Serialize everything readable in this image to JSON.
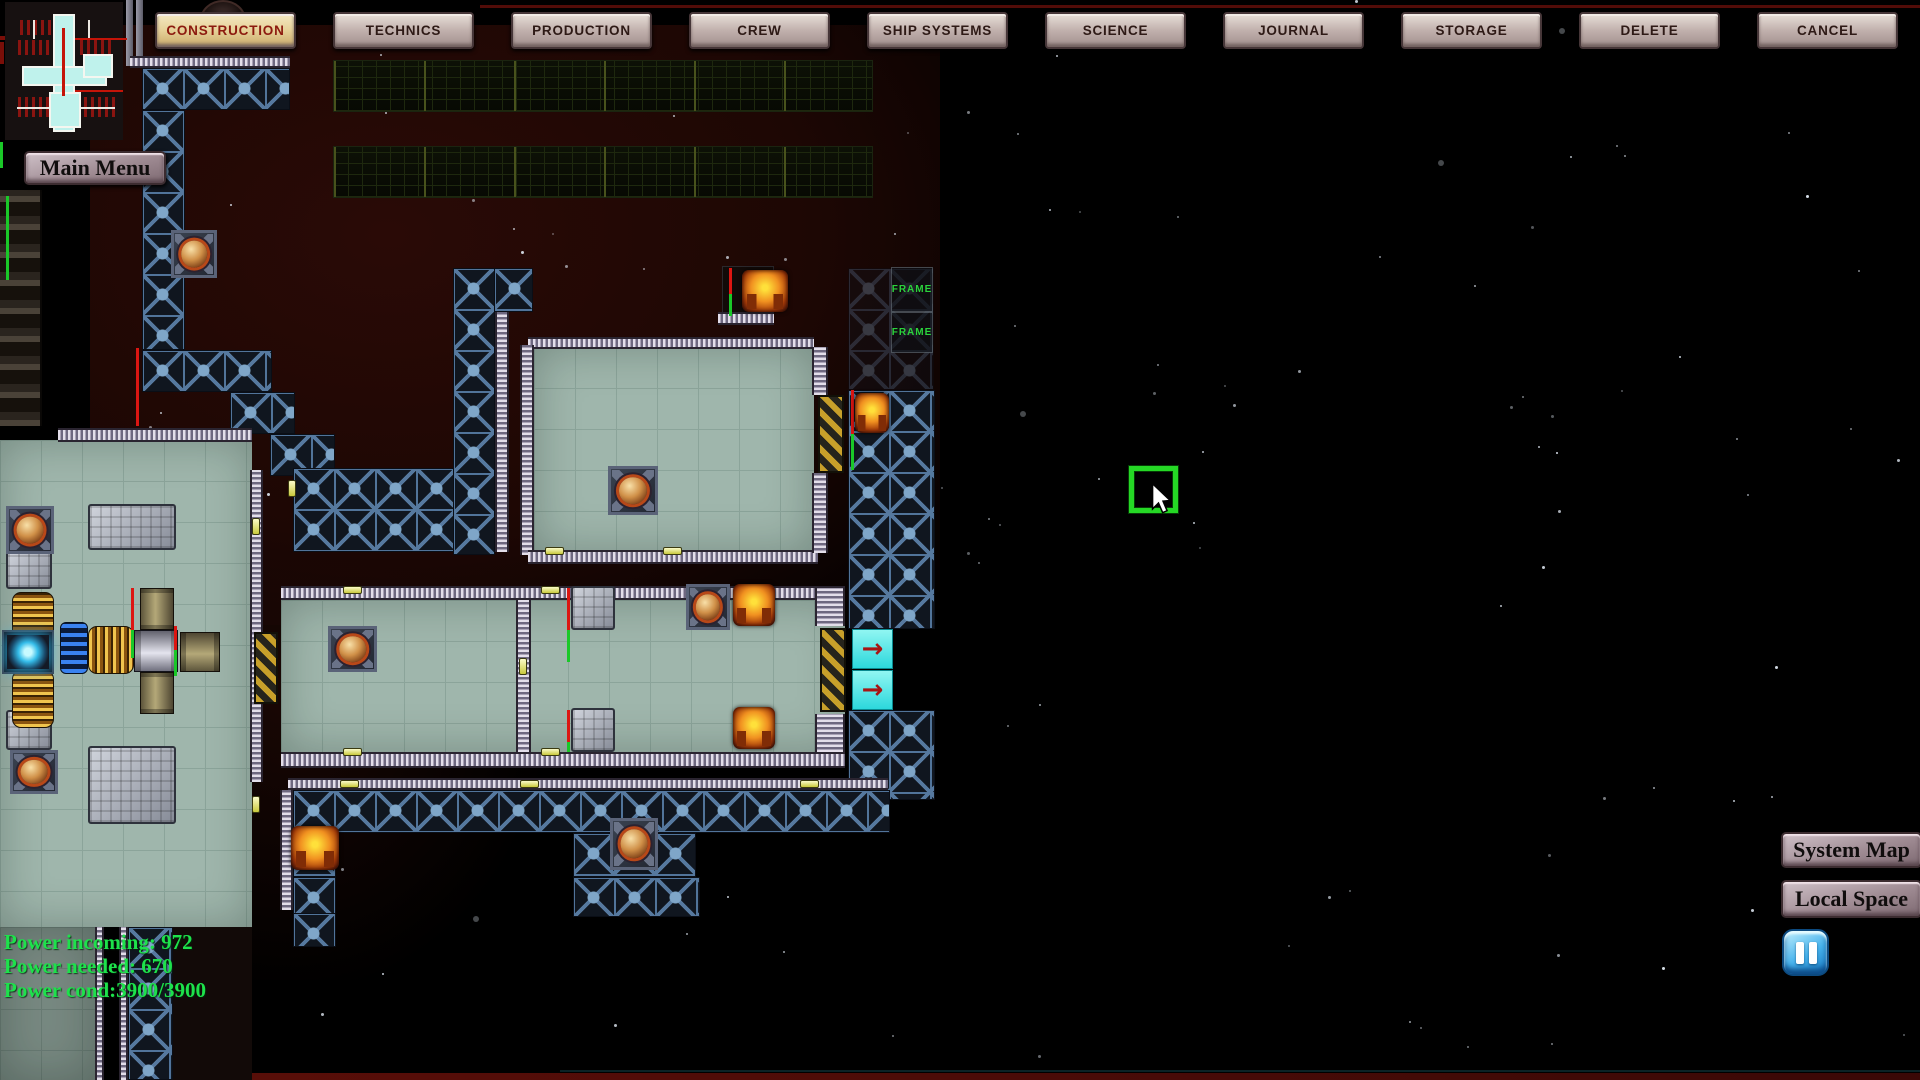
{
  "toolbar": {
    "buttons": [
      {
        "label": "CONSTRUCTION",
        "active": true
      },
      {
        "label": "TECHNICS",
        "active": false
      },
      {
        "label": "PRODUCTION",
        "active": false
      },
      {
        "label": "CREW",
        "active": false
      },
      {
        "label": "SHIP SYSTEMS",
        "active": false
      },
      {
        "label": "SCIENCE",
        "active": false
      },
      {
        "label": "JOURNAL",
        "active": false
      },
      {
        "label": "STORAGE",
        "active": false
      },
      {
        "label": "DELETE",
        "active": false
      },
      {
        "label": "CANCEL",
        "active": false
      }
    ]
  },
  "menu": {
    "main_menu_label": "Main Menu"
  },
  "power": {
    "lines": [
      "Power incoming: 972",
      "Power needed: 670",
      "Power cond:3900/3900"
    ],
    "text_color": "#1de24b"
  },
  "nav": {
    "system_map_label": "System Map",
    "local_space_label": "Local Space"
  },
  "construction": {
    "frame_label": "FRAME"
  },
  "conveyor": {
    "arrow_glyph": "→",
    "arrow_color": "#a81414",
    "tile_color": "#3ae8e8"
  },
  "colors": {
    "selection": "#25d825",
    "frame_text": "#2bd23c",
    "power_text": "#1de24b"
  }
}
